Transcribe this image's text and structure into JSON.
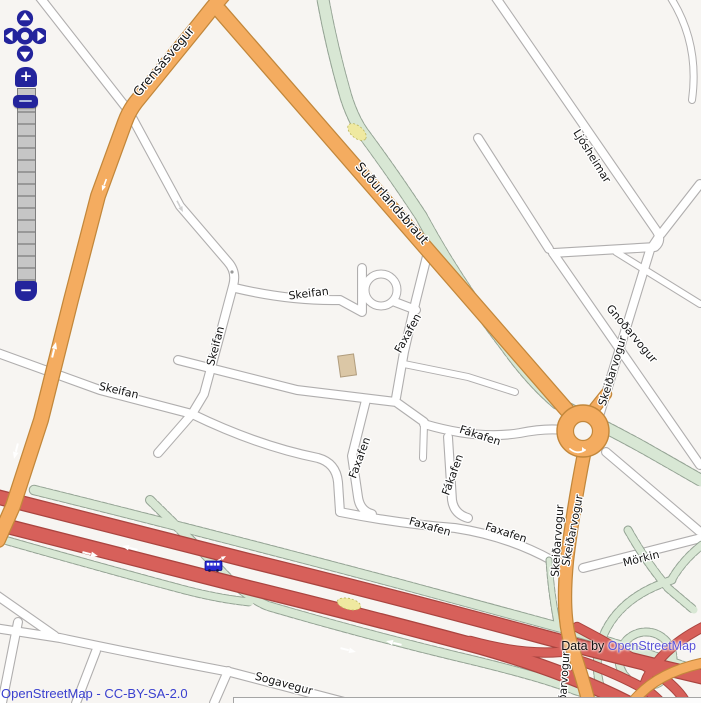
{
  "attribution": {
    "map_license": "OpenStreetMap - CC-BY-SA-2.0",
    "data_by_prefix": "Data by ",
    "data_by_link": "OpenStreetMap"
  },
  "controls": {
    "zoom_in": "+",
    "zoom_out": "−",
    "pan_icons": [
      "pan-up-icon",
      "pan-left-icon",
      "pan-right-icon",
      "pan-down-icon"
    ]
  },
  "map": {
    "colors": {
      "background": "#f7f5f2",
      "primary_road": "#f4ac60",
      "motorway": "#d7605a",
      "greenway": "#d8e7d4",
      "control_navy": "#23249c",
      "attribution_link": "#5a52d8"
    },
    "icons": [
      {
        "name": "bus-icon"
      }
    ],
    "labels": [
      {
        "text": "Grensásvegur"
      },
      {
        "text": "Suðurlandsbraut"
      },
      {
        "text": "Ljósheimar"
      },
      {
        "text": "Gnoðarvogur"
      },
      {
        "text": "Skeiðarvogur"
      },
      {
        "text": "Skeifan"
      },
      {
        "text": "Skeifan"
      },
      {
        "text": "Skeifan"
      },
      {
        "text": "Faxafen"
      },
      {
        "text": "Faxafen"
      },
      {
        "text": "Fákafen"
      },
      {
        "text": "Fákafen"
      },
      {
        "text": "Faxafen"
      },
      {
        "text": "Faxafen"
      },
      {
        "text": "Skeiðarvogur"
      },
      {
        "text": "Skeiðarvogur"
      },
      {
        "text": "Skeiðarvogur"
      },
      {
        "text": "Mörkin"
      },
      {
        "text": "Sogavegur"
      }
    ]
  }
}
